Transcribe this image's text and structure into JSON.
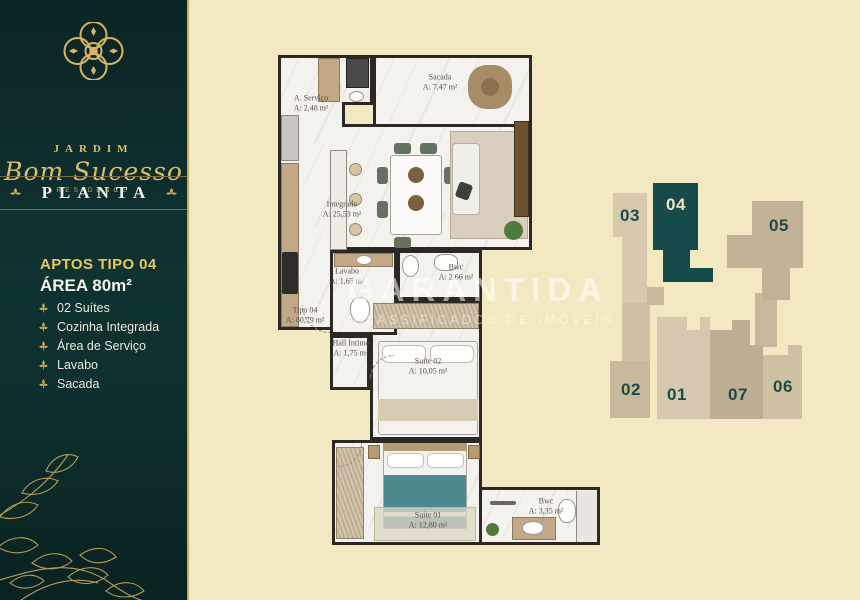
{
  "brand": {
    "name_top": "JARDIM",
    "name_script": "Bom Sucesso",
    "name_sub": "RESIDENCE"
  },
  "sidebar": {
    "section_title": "PLANTA",
    "plan_title": "APTOS TIPO 04",
    "plan_area": "ÁREA 80m²",
    "features": [
      "02 Suítes",
      "Cozinha Integrada",
      "Área de Serviço",
      "Lavabo",
      "Sacada"
    ]
  },
  "floorplan": {
    "unit_label": {
      "name": "Tipo 04",
      "area": "A: 80,79 m²"
    },
    "rooms": [
      {
        "id": "servico",
        "name": "A. Serviço",
        "area": "A: 2,48 m²"
      },
      {
        "id": "sacada",
        "name": "Sacada",
        "area": "A: 7,47 m²"
      },
      {
        "id": "integrado",
        "name": "Integrado",
        "area": "A: 25,53 m²"
      },
      {
        "id": "lavabo",
        "name": "Lavabo",
        "area": "A: 1,65 m²"
      },
      {
        "id": "bwc1",
        "name": "Bwc",
        "area": "A: 2,66 m²"
      },
      {
        "id": "hall",
        "name": "Hall Íntimo",
        "area": "A: 1,75 m²"
      },
      {
        "id": "suite02",
        "name": "Suíte 02",
        "area": "A: 10,05 m²"
      },
      {
        "id": "suite01",
        "name": "Suíte 01",
        "area": "A: 12,80 m²"
      },
      {
        "id": "bwc2",
        "name": "Bwc",
        "area": "A: 3,35 m²"
      }
    ]
  },
  "watermark": {
    "line1": "GARANTIDA",
    "line2": "CLASSIFICADOS DE IMÓVEIS"
  },
  "keyplan": {
    "highlighted": "04",
    "units": [
      {
        "label": "03"
      },
      {
        "label": "04"
      },
      {
        "label": "05"
      },
      {
        "label": "02"
      },
      {
        "label": "01"
      },
      {
        "label": "07"
      },
      {
        "label": "06"
      }
    ]
  },
  "colors": {
    "background": "#f2e9c3",
    "sidebar": "#0d2e2c",
    "gold": "#d7b565",
    "highlight_unit": "#164a4b",
    "unit_number": "#1d4a49",
    "wall": "#2c2825"
  }
}
